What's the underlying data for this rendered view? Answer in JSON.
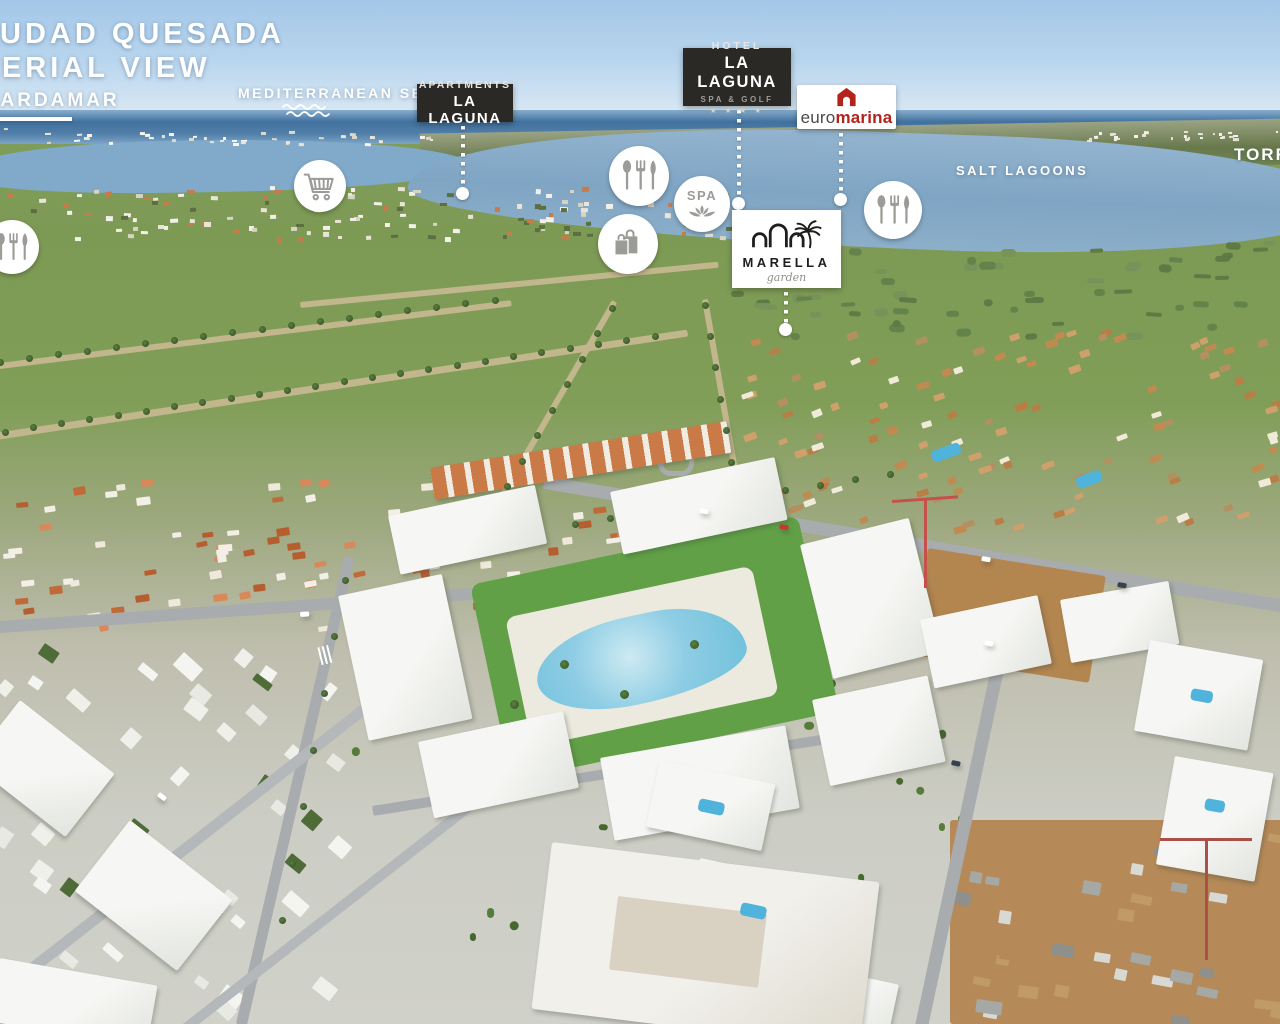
{
  "header": {
    "title_line1": "CIUDAD QUESADA",
    "title_line2": "AERIAL VIEW",
    "direction_label": "GUARDAMAR"
  },
  "map_labels": {
    "sea": "MEDITERRANEAN SEA",
    "salt_lagoons": "SALT LAGOONS",
    "city_right": "TORREVIEJA"
  },
  "badges": {
    "apartments": {
      "top": "APARTMENTS",
      "name": "LA LAGUNA"
    },
    "hotel": {
      "top": "HOTEL",
      "name": "LA LAGUNA",
      "subtitle": "SPA & GOLF",
      "stars": "★ ★ ★ ★"
    },
    "euromarina": {
      "part1": "euro",
      "part2": "marina"
    },
    "marella": {
      "name": "MARELLA",
      "subtitle": "garden"
    }
  },
  "poi_icons": [
    {
      "id": "restaurant-left",
      "type": "restaurant-cutlery"
    },
    {
      "id": "supermarket",
      "type": "shopping-cart"
    },
    {
      "id": "restaurant-center",
      "type": "restaurant-cutlery"
    },
    {
      "id": "spa",
      "type": "spa-lotus",
      "label": "SPA"
    },
    {
      "id": "shopping",
      "type": "shopping-bags"
    },
    {
      "id": "restaurant-right",
      "type": "restaurant-cutlery"
    }
  ],
  "colors": {
    "badge_dark": "#2b2926",
    "euromarina_red": "#b3231c",
    "icon_gray": "#9b9b97",
    "label_white": "#ffffff"
  }
}
